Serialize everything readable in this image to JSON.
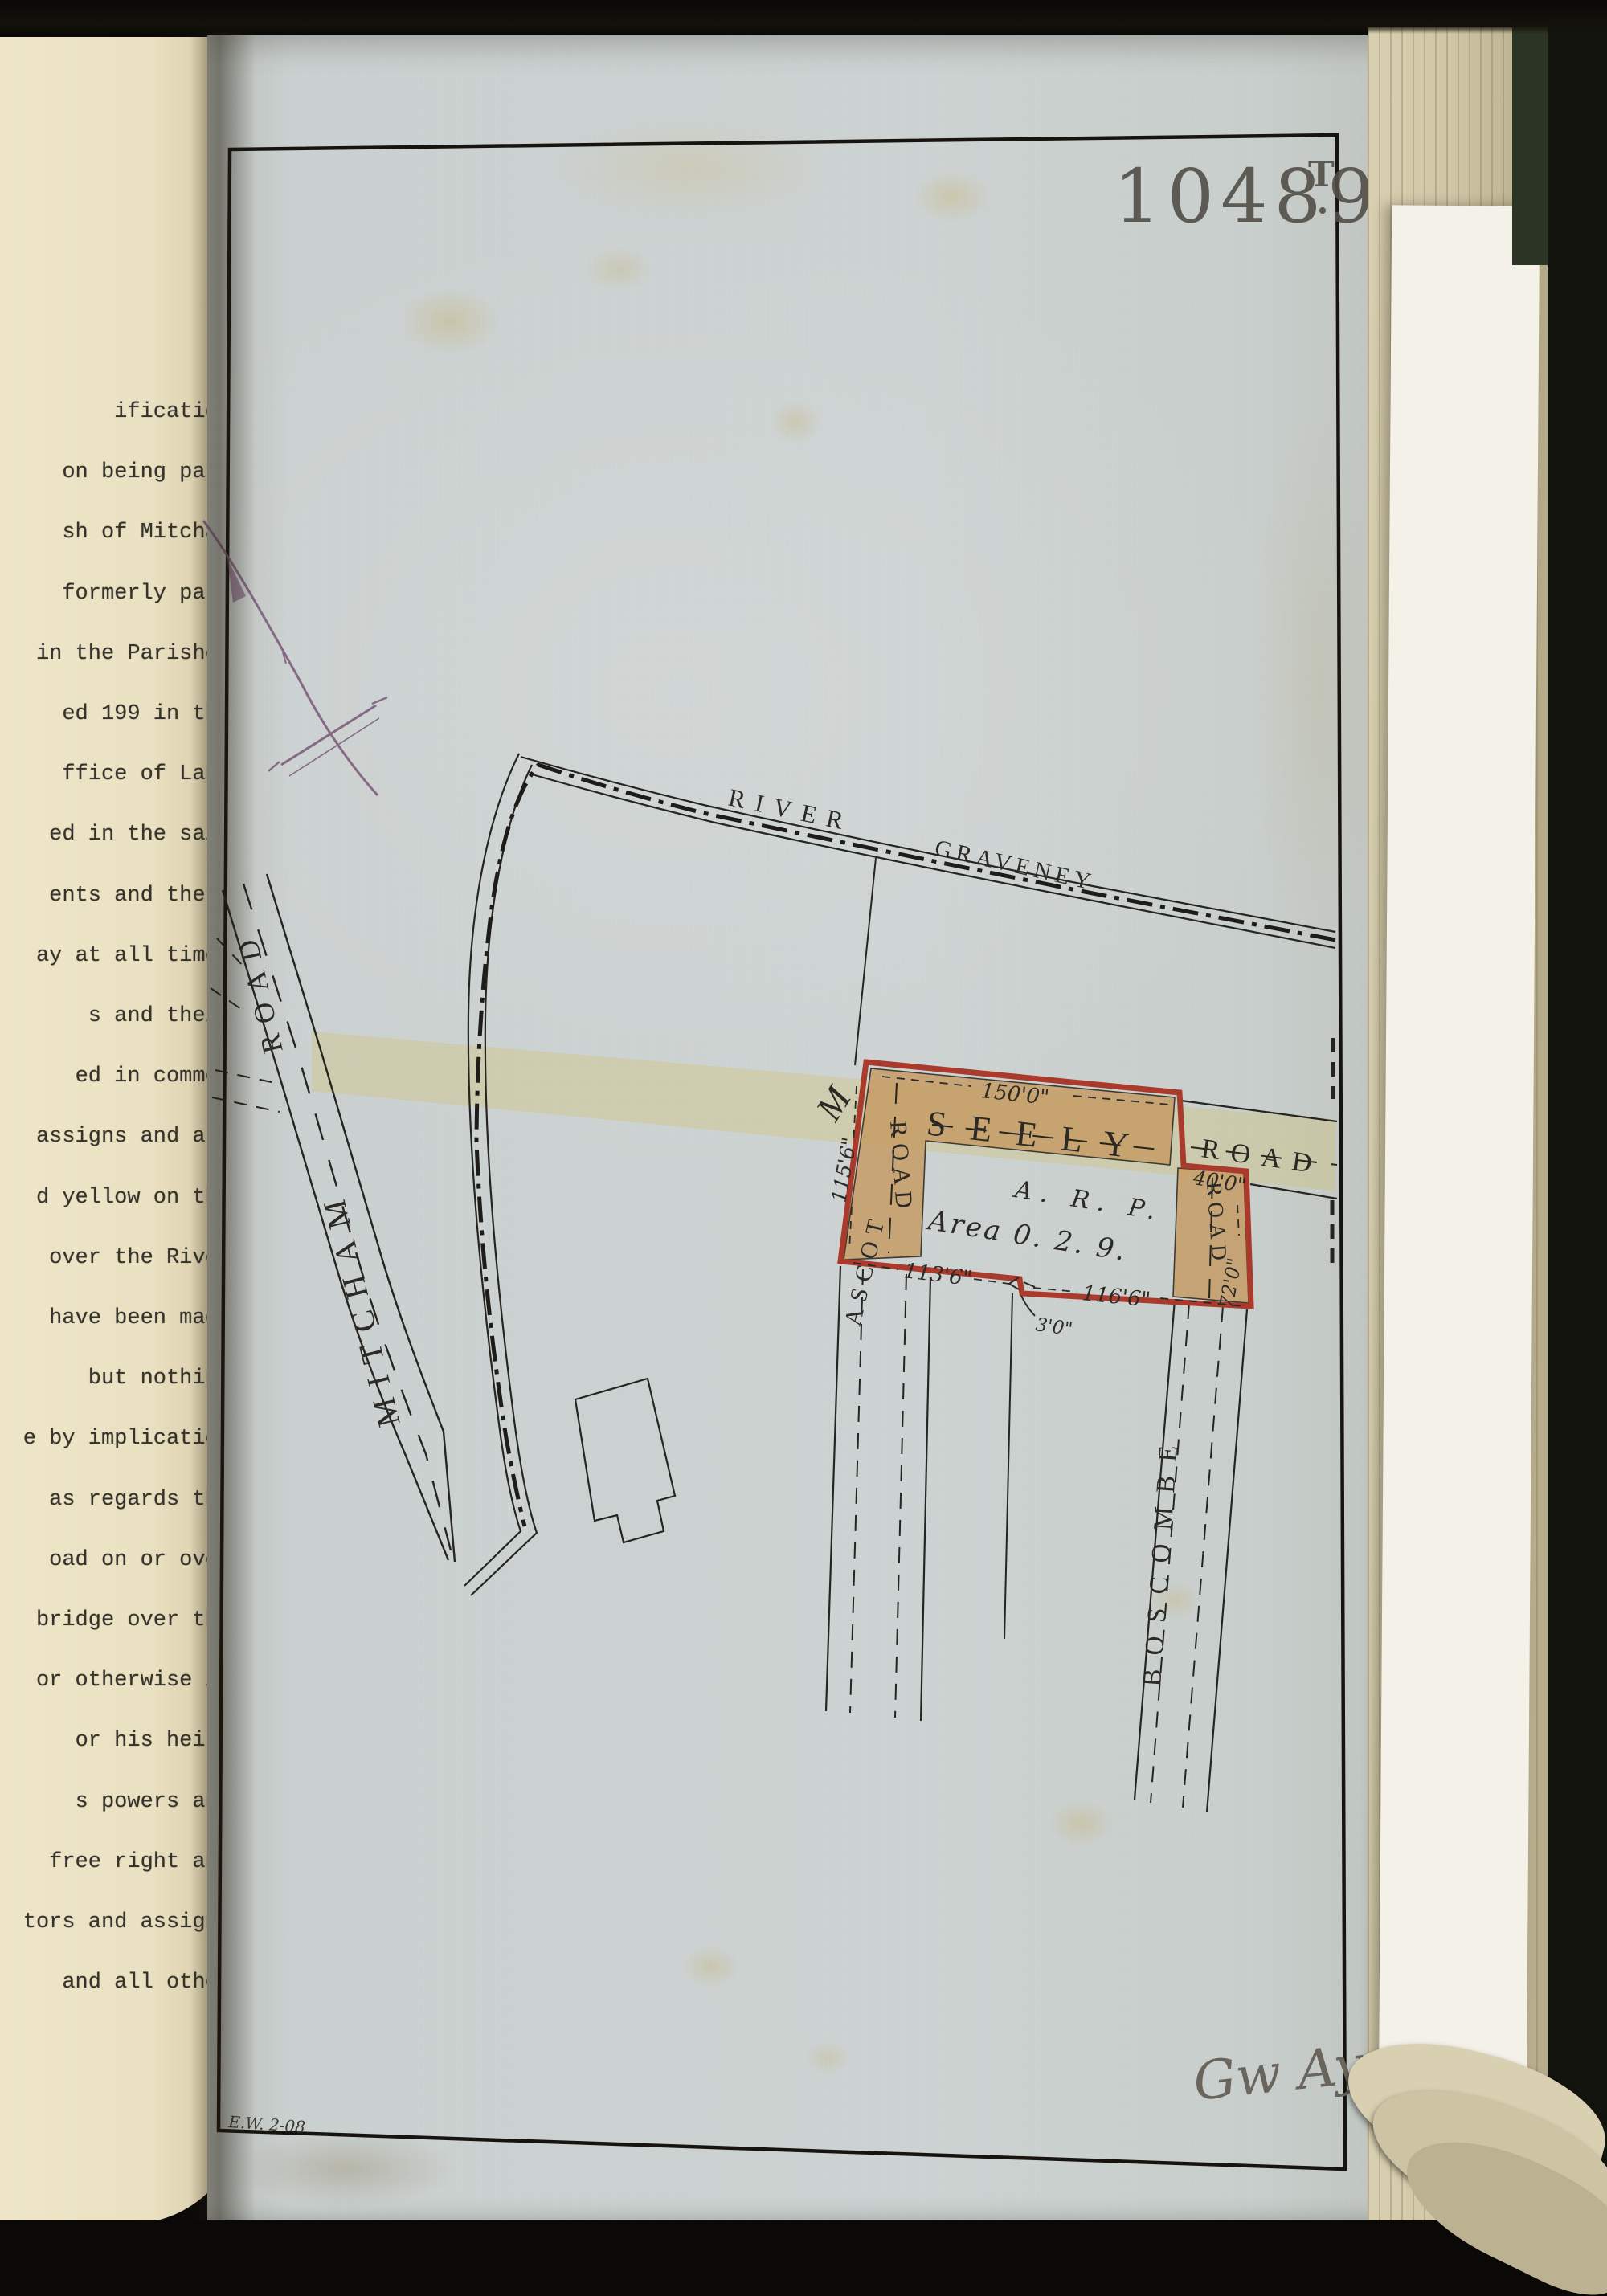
{
  "stamp": {
    "number": "10489",
    "suffix": "T"
  },
  "left_page_text": {
    "lines": [
      "ification",
      "on being part",
      "sh of Mitcham",
      "formerly part",
      "in the Parishes",
      "ed 199 in the",
      "ffice of Land",
      "ed in the said",
      "ents and there",
      "ay at all times",
      "s and their",
      "ed in common",
      "assigns and all",
      "d yellow on the",
      "over the River",
      "have been made",
      "but nothing",
      "e by implication",
      "as regards the",
      "oad on or over",
      "bridge over the",
      "or otherwise in",
      "or his heirs",
      "s powers and",
      "free right and",
      "tors and assigns",
      "and all other"
    ]
  },
  "plan": {
    "river": {
      "word1": "RIVER",
      "word2": "GRAVENEY"
    },
    "roads": {
      "mitcham": "MITCHAM",
      "mitcham_road": "ROAD",
      "seely": "SEELY",
      "seely_east_road": "ROAD",
      "ascot": "ASCOT",
      "ascot_road": "ROAD",
      "boscombe": "BOSCOMBE",
      "boscombe_road": "ROAD",
      "m_label": "M"
    },
    "plot": {
      "area_header": "A. R. P.",
      "area_value": "Area 0. 2. 9.",
      "dim_top": "150'0\"",
      "dim_left": "115'6\"",
      "dim_bottom_left": "113'6\"",
      "dim_bottom_right": "116'6\"",
      "dim_step": "3'0\"",
      "dim_east": "40'0\"",
      "dim_right": "72'0\"",
      "outline_color": "#a93a2c",
      "fill_color": "#c59a62"
    },
    "notes": {
      "surveyor_date": "E.W. 2-08",
      "signature": "Gw Ay"
    },
    "yellow_band_color": "#d4c169"
  }
}
